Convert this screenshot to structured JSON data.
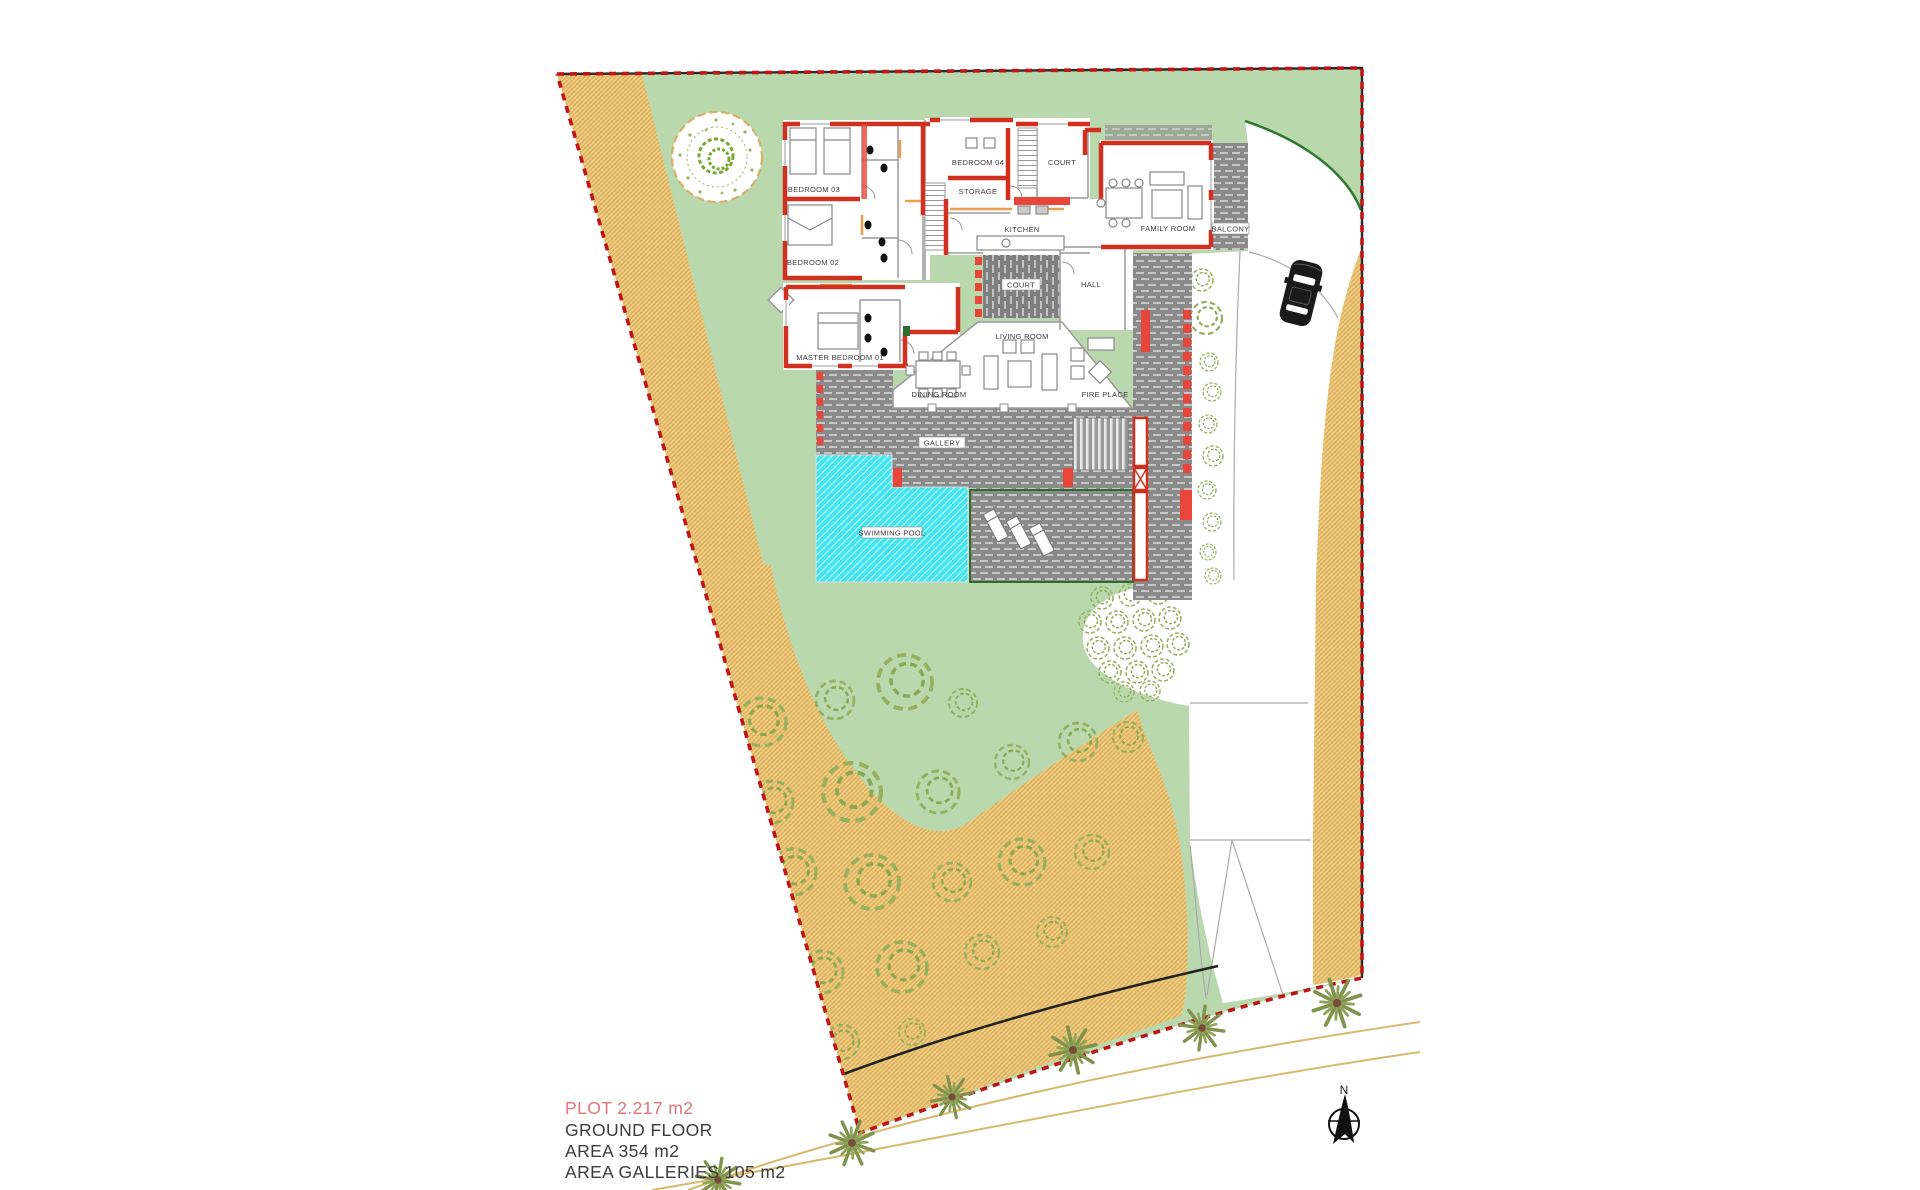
{
  "annotation": {
    "plot_area": "PLOT 2.217 m2",
    "floor": "GROUND FLOOR",
    "area": "AREA 354 m2",
    "area_galleries": "AREA GALLERIES 105 m2",
    "plot_text_color": "#e4737e",
    "text_color": "#3c3c3c"
  },
  "compass": {
    "north_label": "N"
  },
  "rooms": {
    "bedroom03": "BEDROOM 03",
    "bedroom02": "BEDROOM 02",
    "master_bedroom": "MASTER BEDROOM 01",
    "bedroom04": "BEDROOM 04",
    "storage": "STORAGE",
    "court_upper": "COURT",
    "kitchen": "KITCHEN",
    "court_center": "COURT",
    "hall": "HALL",
    "family_room": "FAMILY ROOM",
    "balcony": "BALCONY",
    "living_room": "LIVING ROOM",
    "dining_room": "DINING ROOM",
    "fire_place": "FIRE PLACE",
    "gallery": "GALLERY",
    "swimming_pool": "SWIMMING POOL"
  },
  "colors": {
    "lawn": "#b9d8ae",
    "sand": "#ecc97f",
    "sand_hatch": "#d9ad58",
    "deck_gray": "#8a8a8a",
    "pool_cyan": "#41e5ef",
    "wall_red": "#d2301f",
    "boundary_red": "#c11414",
    "tree_green": "#96b05e",
    "palm_green": "#7f934d",
    "palm_brown": "#7a4d3a",
    "lawn_edge_green": "#2f7a2f"
  }
}
